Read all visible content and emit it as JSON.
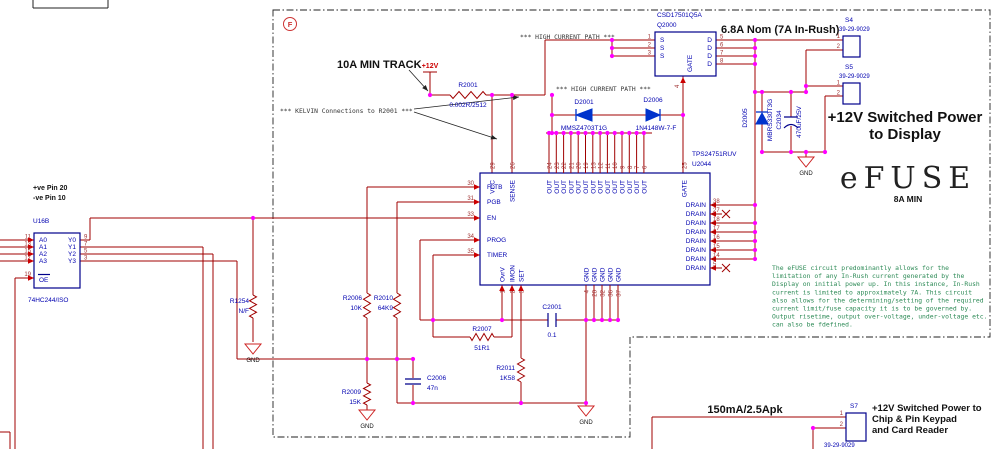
{
  "annotations": {
    "f_marker": "F",
    "pve": "+ve Pin 20",
    "nve": "-ve Pin 10",
    "track": "10A MIN TRACK",
    "kelvin": "*** KELVIN Connections to R2001 ***",
    "high_current_path": "*** HIGH CURRENT PATH ***",
    "plus12v": "+12V",
    "nom": "6.8A Nom (7A In-Rush)",
    "power_display_1": "+12V Switched Power",
    "power_display_2": "to Display",
    "efuse": "eFUSE",
    "efuse_rating": "8A MIN",
    "gnd": "GND",
    "rating_bottom": "150mA/2.5Apk",
    "power_keypad_1": "+12V Switched Power to",
    "power_keypad_2": "Chip & Pin Keypad",
    "power_keypad_3": "and Card Reader",
    "note_lines": [
      "The eFUSE circuit predominantly allows for the",
      "limitation of any In-Rush current generated by the",
      "Display on initial power up. In this instance, In-Rush",
      "current is limited to approximately 7A. This circuit",
      "also allows for the determining/setting of the required",
      "current limit/fuse capacity it is to be governed by.",
      "Output risetime, output over-voltage, under-voltage etc.",
      "can also be fdefined."
    ]
  },
  "u16b": {
    "ref": "U16B",
    "part": "74HC244/ISO",
    "inputs": [
      {
        "num": "11",
        "name": "A0"
      },
      {
        "num": "13",
        "name": "A1"
      },
      {
        "num": "15",
        "name": "A2"
      },
      {
        "num": "17",
        "name": "A3"
      }
    ],
    "outputs": [
      {
        "num": "9",
        "name": "Y0"
      },
      {
        "num": "7",
        "name": "Y1"
      },
      {
        "num": "5",
        "name": "Y2"
      },
      {
        "num": "3",
        "name": "Y3"
      }
    ],
    "oe": {
      "num": "19",
      "name": "OE"
    }
  },
  "q2000": {
    "part": "CSD17501Q5A",
    "ref": "Q2000",
    "s_label": "S",
    "d_label": "D",
    "gate_label": "GATE",
    "gate_num": "4",
    "s_nums": [
      "1",
      "2",
      "3"
    ],
    "d_nums": [
      "5",
      "6",
      "7",
      "8"
    ]
  },
  "u2044": {
    "part": "TPS24751RUV",
    "ref": "U2044",
    "left": [
      {
        "num": "30",
        "name": "FLTB"
      },
      {
        "num": "31",
        "name": "PGB"
      },
      {
        "num": "33",
        "name": "EN"
      },
      {
        "num": "34",
        "name": "PROG"
      },
      {
        "num": "35",
        "name": "TIMER"
      }
    ],
    "vcc": {
      "num": "29",
      "name": "VCC"
    },
    "sense": {
      "num": "26",
      "name": "SENSE"
    },
    "out_nums": [
      "24",
      "23",
      "22",
      "21",
      "20",
      "19",
      "13",
      "12",
      "11",
      "10",
      "9",
      "8",
      "7",
      "6"
    ],
    "out_label": "OUT",
    "gate": {
      "num": "25",
      "name": "GATE"
    },
    "drain_nums": [
      "38",
      "27",
      "18",
      "17",
      "16",
      "15",
      "14",
      "5"
    ],
    "drain_label": "DRAIN",
    "bottom": [
      {
        "num": "1",
        "name": "OvrV"
      },
      {
        "num": "2",
        "name": "IMON"
      },
      {
        "num": "3",
        "name": "SET"
      }
    ],
    "gnd_nums": [
      "4",
      "28",
      "32",
      "36",
      "37"
    ],
    "gnd_label": "GND"
  },
  "parts": {
    "r2001": {
      "ref": "R2001",
      "value": "0.002R/2512"
    },
    "d2001": {
      "ref": "D2001",
      "value": "MMSZ4703T1G"
    },
    "d2006": {
      "ref": "D2006",
      "value": "1N4148W-7-F"
    },
    "d2005": {
      "ref": "D2005",
      "value": "MBRS330T3G"
    },
    "c2034": {
      "ref": "C2034",
      "value": "470uF/25V"
    },
    "r1254": {
      "ref": "R1254",
      "value": "N/F"
    },
    "r2006": {
      "ref": "R2006",
      "value": "10K"
    },
    "r2010": {
      "ref": "R2010",
      "value": "64K9"
    },
    "r2009": {
      "ref": "R2009",
      "value": "15K"
    },
    "c2006": {
      "ref": "C2006",
      "value": "47n"
    },
    "r2007": {
      "ref": "R2007",
      "value": "51R1"
    },
    "r2011": {
      "ref": "R2011",
      "value": "1K58"
    },
    "c2001": {
      "ref": "C2001",
      "value": "0.1"
    }
  },
  "connectors": {
    "s4": {
      "ref": "S4",
      "part": "39-29-9029",
      "pins": [
        "1",
        "2"
      ]
    },
    "s5": {
      "ref": "S5",
      "part": "39-29-9029",
      "pins": [
        "1",
        "2"
      ]
    },
    "s7": {
      "ref": "S7",
      "part": "39-29-9029",
      "pins": [
        "1",
        "2"
      ]
    }
  }
}
